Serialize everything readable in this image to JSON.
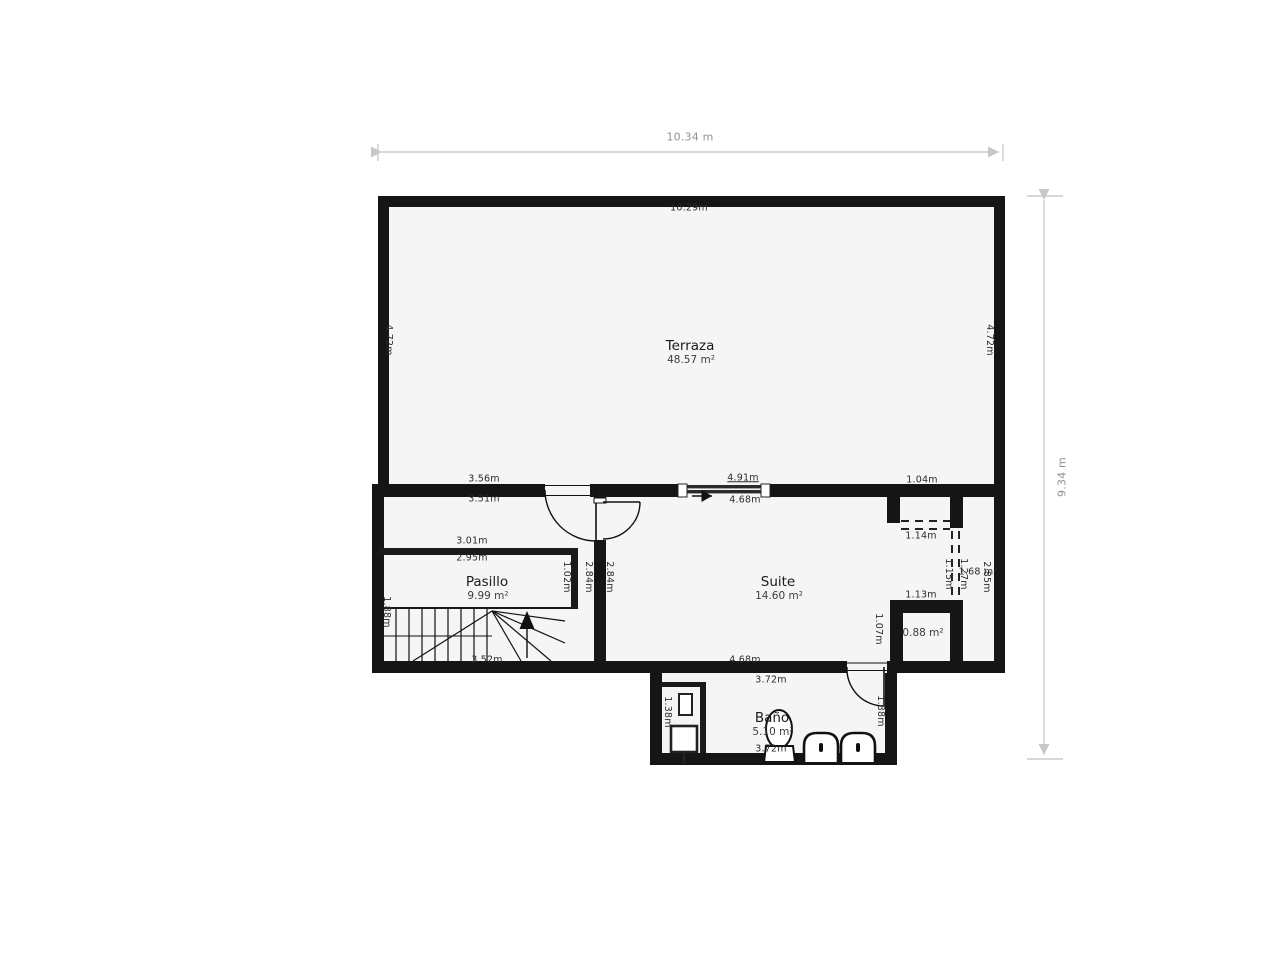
{
  "plan": {
    "type_label": "floor-plan",
    "colors": {
      "wall": "#151515",
      "floor": "#f5f5f6",
      "dim_line": "#cccccc",
      "dim_text_outer": "#929292",
      "dim_text": "#2b2b2b"
    }
  },
  "overall_dimensions": {
    "width_label": "10.34 m",
    "height_label": "9.34 m"
  },
  "rooms": [
    {
      "name": "Terraza",
      "area": "48.57 m²",
      "x": 690,
      "y": 346
    },
    {
      "name": "Pasillo",
      "area": "9.99 m²",
      "x": 487,
      "y": 582
    },
    {
      "name": "Suite",
      "area": "14.60 m²",
      "x": 778,
      "y": 582
    },
    {
      "name": "Baño",
      "area": "5.10 m²",
      "x": 772,
      "y": 718
    },
    {
      "name": "",
      "area": "0.88 m²",
      "x": 923,
      "y": 633
    }
  ],
  "measurements": [
    {
      "t": "10.34 m",
      "x": 690,
      "y": 137,
      "r": 0,
      "k": "outer"
    },
    {
      "t": "9.34 m",
      "x": 1062,
      "y": 477,
      "r": -90,
      "k": "outer"
    },
    {
      "t": "10.29m",
      "x": 689,
      "y": 208,
      "r": 0
    },
    {
      "t": "4.72m",
      "x": 388,
      "y": 340,
      "r": 90
    },
    {
      "t": "4.72m",
      "x": 989,
      "y": 340,
      "r": 90
    },
    {
      "t": "3.56m",
      "x": 484,
      "y": 479,
      "r": 0
    },
    {
      "t": "3.51m",
      "x": 484,
      "y": 499,
      "r": 0
    },
    {
      "t": "4.91m",
      "x": 743,
      "y": 478,
      "r": 0,
      "u": true
    },
    {
      "t": "4.68m",
      "x": 745,
      "y": 500,
      "r": 0
    },
    {
      "t": "1.04m",
      "x": 922,
      "y": 480,
      "r": 0
    },
    {
      "t": "1.14m",
      "x": 921,
      "y": 536,
      "r": 0
    },
    {
      "t": "1.15m",
      "x": 948,
      "y": 574,
      "r": 90
    },
    {
      "t": "1.27m",
      "x": 963,
      "y": 574,
      "r": 90
    },
    {
      "t": "1.68 m²",
      "x": 978,
      "y": 572,
      "r": 0
    },
    {
      "t": "2.85m",
      "x": 986,
      "y": 577,
      "r": 90
    },
    {
      "t": "3.01m",
      "x": 472,
      "y": 541,
      "r": 0
    },
    {
      "t": "2.95m",
      "x": 472,
      "y": 558,
      "r": 0
    },
    {
      "t": "1.02m",
      "x": 566,
      "y": 577,
      "r": 90
    },
    {
      "t": "2.84m",
      "x": 588,
      "y": 577,
      "r": 90
    },
    {
      "t": "2.84m",
      "x": 609,
      "y": 577,
      "r": 90
    },
    {
      "t": "1.88m",
      "x": 386,
      "y": 612,
      "r": 90
    },
    {
      "t": "3.52m",
      "x": 487,
      "y": 660,
      "r": 0
    },
    {
      "t": "1.13m",
      "x": 921,
      "y": 595,
      "r": 0
    },
    {
      "t": "1.07m",
      "x": 878,
      "y": 629,
      "r": 90
    },
    {
      "t": "4.68m",
      "x": 745,
      "y": 660,
      "r": 0
    },
    {
      "t": "3.72m",
      "x": 771,
      "y": 680,
      "r": 0
    },
    {
      "t": "3.72m",
      "x": 771,
      "y": 749,
      "r": 0
    },
    {
      "t": "1.38m",
      "x": 667,
      "y": 712,
      "r": 90
    },
    {
      "t": "1.38m",
      "x": 880,
      "y": 711,
      "r": 90
    }
  ]
}
